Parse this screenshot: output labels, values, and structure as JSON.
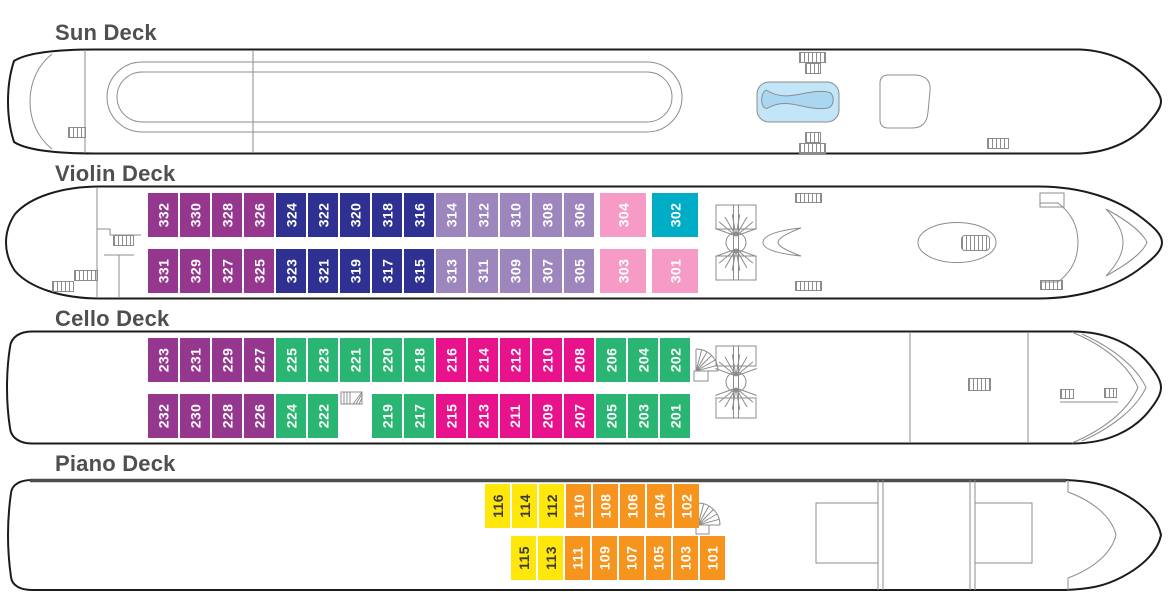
{
  "colors": {
    "purple": "#95368f",
    "navy": "#2e3192",
    "mauve": "#9d85bd",
    "pink": "#f59bc6",
    "teal": "#00adc6",
    "green": "#2ab573",
    "magenta": "#e7128c",
    "yellow": "#ffe70c",
    "orange": "#f6941e",
    "pool_fill": "#c3e5f8",
    "pool_inner": "#a9d7f2",
    "hull_line": "#1b1b1b",
    "detail_line": "#8c8c8c",
    "title_text": "#4f4f4f"
  },
  "decks": [
    {
      "title": "Sun Deck",
      "rows": []
    },
    {
      "title": "Violin Deck",
      "rows": [
        {
          "cabins": [
            {
              "n": "332",
              "c": "purple"
            },
            {
              "n": "330",
              "c": "purple"
            },
            {
              "n": "328",
              "c": "purple"
            },
            {
              "n": "326",
              "c": "purple"
            },
            {
              "n": "324",
              "c": "navy"
            },
            {
              "n": "322",
              "c": "navy"
            },
            {
              "n": "320",
              "c": "navy"
            },
            {
              "n": "318",
              "c": "navy"
            },
            {
              "n": "316",
              "c": "navy"
            },
            {
              "n": "314",
              "c": "mauve"
            },
            {
              "n": "312",
              "c": "mauve"
            },
            {
              "n": "310",
              "c": "mauve"
            },
            {
              "n": "308",
              "c": "mauve"
            },
            {
              "n": "306",
              "c": "mauve"
            },
            {
              "n": "304",
              "c": "pink",
              "wide": true
            },
            {
              "n": "302",
              "c": "teal",
              "wide": true
            }
          ]
        },
        {
          "cabins": [
            {
              "n": "331",
              "c": "purple"
            },
            {
              "n": "329",
              "c": "purple"
            },
            {
              "n": "327",
              "c": "purple"
            },
            {
              "n": "325",
              "c": "purple"
            },
            {
              "n": "323",
              "c": "navy"
            },
            {
              "n": "321",
              "c": "navy"
            },
            {
              "n": "319",
              "c": "navy"
            },
            {
              "n": "317",
              "c": "navy"
            },
            {
              "n": "315",
              "c": "navy"
            },
            {
              "n": "313",
              "c": "mauve"
            },
            {
              "n": "311",
              "c": "mauve"
            },
            {
              "n": "309",
              "c": "mauve"
            },
            {
              "n": "307",
              "c": "mauve"
            },
            {
              "n": "305",
              "c": "mauve"
            },
            {
              "n": "303",
              "c": "pink",
              "wide": true
            },
            {
              "n": "301",
              "c": "pink",
              "wide": true
            }
          ]
        }
      ]
    },
    {
      "title": "Cello Deck",
      "rows": [
        {
          "cabins": [
            {
              "n": "233",
              "c": "purple"
            },
            {
              "n": "231",
              "c": "purple"
            },
            {
              "n": "229",
              "c": "purple"
            },
            {
              "n": "227",
              "c": "purple"
            },
            {
              "n": "225",
              "c": "green"
            },
            {
              "n": "223",
              "c": "green"
            },
            {
              "n": "221",
              "c": "green"
            },
            {
              "n": "220",
              "c": "green"
            },
            {
              "n": "218",
              "c": "green"
            },
            {
              "n": "216",
              "c": "magenta"
            },
            {
              "n": "214",
              "c": "magenta"
            },
            {
              "n": "212",
              "c": "magenta"
            },
            {
              "n": "210",
              "c": "magenta"
            },
            {
              "n": "208",
              "c": "magenta"
            },
            {
              "n": "206",
              "c": "green"
            },
            {
              "n": "204",
              "c": "green"
            },
            {
              "n": "202",
              "c": "green"
            }
          ]
        },
        {
          "cabins": [
            {
              "n": "232",
              "c": "purple"
            },
            {
              "n": "230",
              "c": "purple"
            },
            {
              "n": "228",
              "c": "purple"
            },
            {
              "n": "226",
              "c": "purple"
            },
            {
              "n": "224",
              "c": "green"
            },
            {
              "n": "222",
              "c": "green"
            },
            {
              "gap": true
            },
            {
              "n": "219",
              "c": "green"
            },
            {
              "n": "217",
              "c": "green"
            },
            {
              "n": "215",
              "c": "magenta"
            },
            {
              "n": "213",
              "c": "magenta"
            },
            {
              "n": "211",
              "c": "magenta"
            },
            {
              "n": "209",
              "c": "magenta"
            },
            {
              "n": "207",
              "c": "magenta"
            },
            {
              "n": "205",
              "c": "green"
            },
            {
              "n": "203",
              "c": "green"
            },
            {
              "n": "201",
              "c": "green"
            }
          ]
        }
      ]
    },
    {
      "title": "Piano Deck",
      "rows": [
        {
          "cabins": [
            {
              "n": "116",
              "c": "yellow",
              "dark": true
            },
            {
              "n": "114",
              "c": "yellow",
              "dark": true
            },
            {
              "n": "112",
              "c": "yellow",
              "dark": true
            },
            {
              "n": "110",
              "c": "orange"
            },
            {
              "n": "108",
              "c": "orange"
            },
            {
              "n": "106",
              "c": "orange"
            },
            {
              "n": "104",
              "c": "orange"
            },
            {
              "n": "102",
              "c": "orange"
            }
          ]
        },
        {
          "cabins": [
            {
              "n": "115",
              "c": "yellow",
              "dark": true
            },
            {
              "n": "113",
              "c": "yellow",
              "dark": true
            },
            {
              "n": "111",
              "c": "orange"
            },
            {
              "n": "109",
              "c": "orange"
            },
            {
              "n": "107",
              "c": "orange"
            },
            {
              "n": "105",
              "c": "orange"
            },
            {
              "n": "103",
              "c": "orange"
            },
            {
              "n": "101",
              "c": "orange"
            }
          ]
        }
      ]
    }
  ]
}
